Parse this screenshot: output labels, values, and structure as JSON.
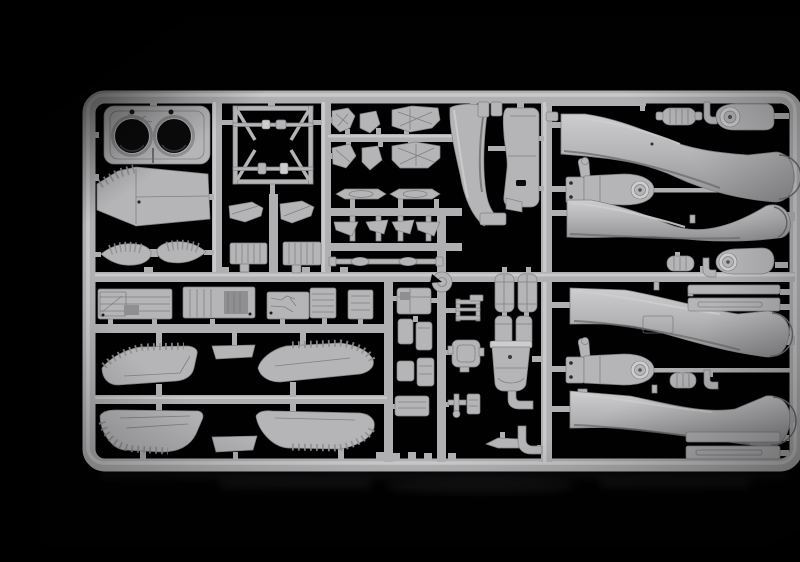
{
  "meta": {
    "type": "photograph",
    "alt": "Light grey injection-moulded plastic model kit sprue photographed on a glossy black background, holding aircraft parts: an intake bulkhead with two round openings, four S-shaped intake trunk ducts, wing panels with ribbed edges, cockpit tubs, ejection-seat pieces, small equipment boxes and fittings."
  },
  "palette": {
    "bg": "#010101",
    "plastic": "#b5b5b7",
    "plastic-bright": "#cdcdcf",
    "plastic-dark": "#8f8f92",
    "plastic-shadow": "#6e6e71",
    "runner": "#b0b0b2",
    "runner-bright": "#c9c9cb",
    "edge": "#828285",
    "line": "#77777a",
    "hole": "#0b0b0b"
  },
  "sprue": {
    "material": "grey styrene",
    "background": "black",
    "parts": [
      {
        "name": "intake-bulkhead",
        "label": "bulkhead panel with two circular intake openings"
      },
      {
        "name": "nose-bay-panel",
        "label": "tapered bay panel with ribbed edge"
      },
      {
        "name": "cone-halves",
        "label": "two ribbed tail-cone halves"
      },
      {
        "name": "support-frame",
        "label": "square tubular support frame with corner braces"
      },
      {
        "name": "seat-components",
        "label": "ejection seat halves and cockpit fittings"
      },
      {
        "name": "sill-strips",
        "label": "two slender canopy sill strips"
      },
      {
        "name": "splitter-blade",
        "label": "curved intake splitter blade"
      },
      {
        "name": "keel-panel",
        "label": "tall keel panel"
      },
      {
        "name": "gear-mounts",
        "label": "two gear mount beams with round hubs"
      },
      {
        "name": "intake-ducts",
        "label": "four long S-curved intake trunk ducts"
      },
      {
        "name": "intake-lips",
        "label": "paddle-shaped lip fairings with circular bosses"
      },
      {
        "name": "ribbed-cylinders",
        "label": "small ribbed cylinder fittings with elbow pipes"
      },
      {
        "name": "ramp-strips",
        "label": "slotted intake ramp strips"
      },
      {
        "name": "cockpit-tubs",
        "label": "row of detailed cockpit tub floors"
      },
      {
        "name": "wedges-boxes",
        "label": "wedge sections and finned equipment boxes"
      },
      {
        "name": "brackets-rods",
        "label": "four triangular brackets and linkage rods"
      },
      {
        "name": "equipment-grid",
        "label": "grid of small avionics boxes, tanks and a notched disc"
      },
      {
        "name": "exhaust-bucket",
        "label": "bucket-shaped duct section with drain pipe"
      },
      {
        "name": "wing-panels",
        "label": "four wing panels with louvered rib edges plus two flap tabs"
      }
    ]
  }
}
